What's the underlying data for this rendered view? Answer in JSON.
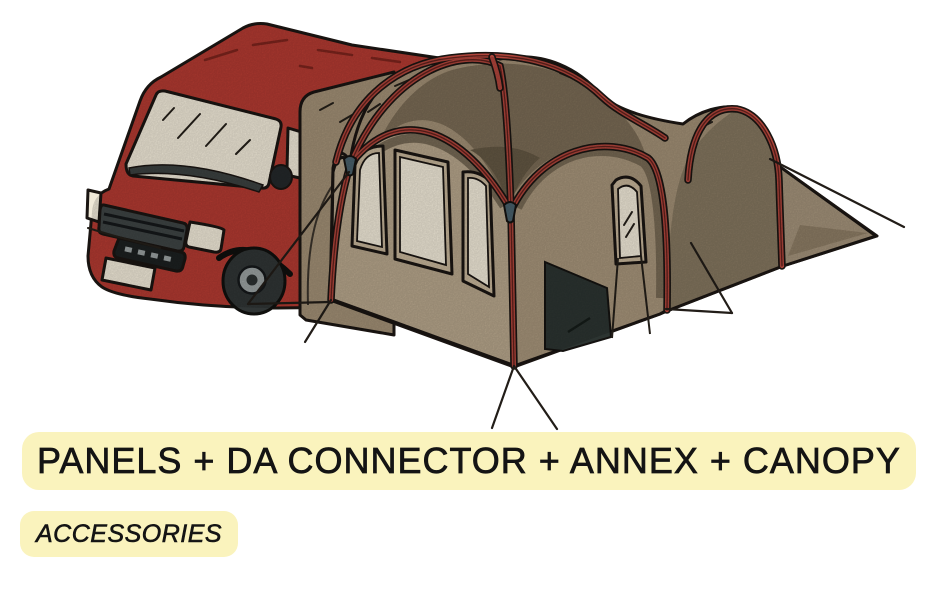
{
  "banner": {
    "title": "PANELS + DA CONNECTOR + ANNEX + CANOPY",
    "subtitle": "ACCESSORIES",
    "highlight_color": "#FAF3BD",
    "text_color": "#141414"
  },
  "illustration": {
    "alt": "Red camper van attached to a tan drive-away awning tent with front panels, DA connector tunnel, annex tunnel, canopy dome, red poles and guy ropes",
    "colors": {
      "van_red": "#B23A31",
      "van_red_dark": "#7C241D",
      "fabric_light": "#B6A58B",
      "fabric_mid": "#A18F75",
      "fabric_mid2": "#A6947A",
      "fabric_dark": "#7A6B55",
      "fabric_darker": "#635743",
      "annex_side": "#84765F",
      "annex_tail": "#A3927A",
      "pole_red": "#B0453B",
      "window_cream": "#F0E9D8",
      "window_frame": "#C5B499",
      "door_dark": "#2C3431",
      "grille_gray": "#3E4444",
      "rim_gray": "#9AA1A1",
      "clip_slate": "#49606B",
      "outline": "#1A1512",
      "background": "#FFFFFF"
    }
  }
}
